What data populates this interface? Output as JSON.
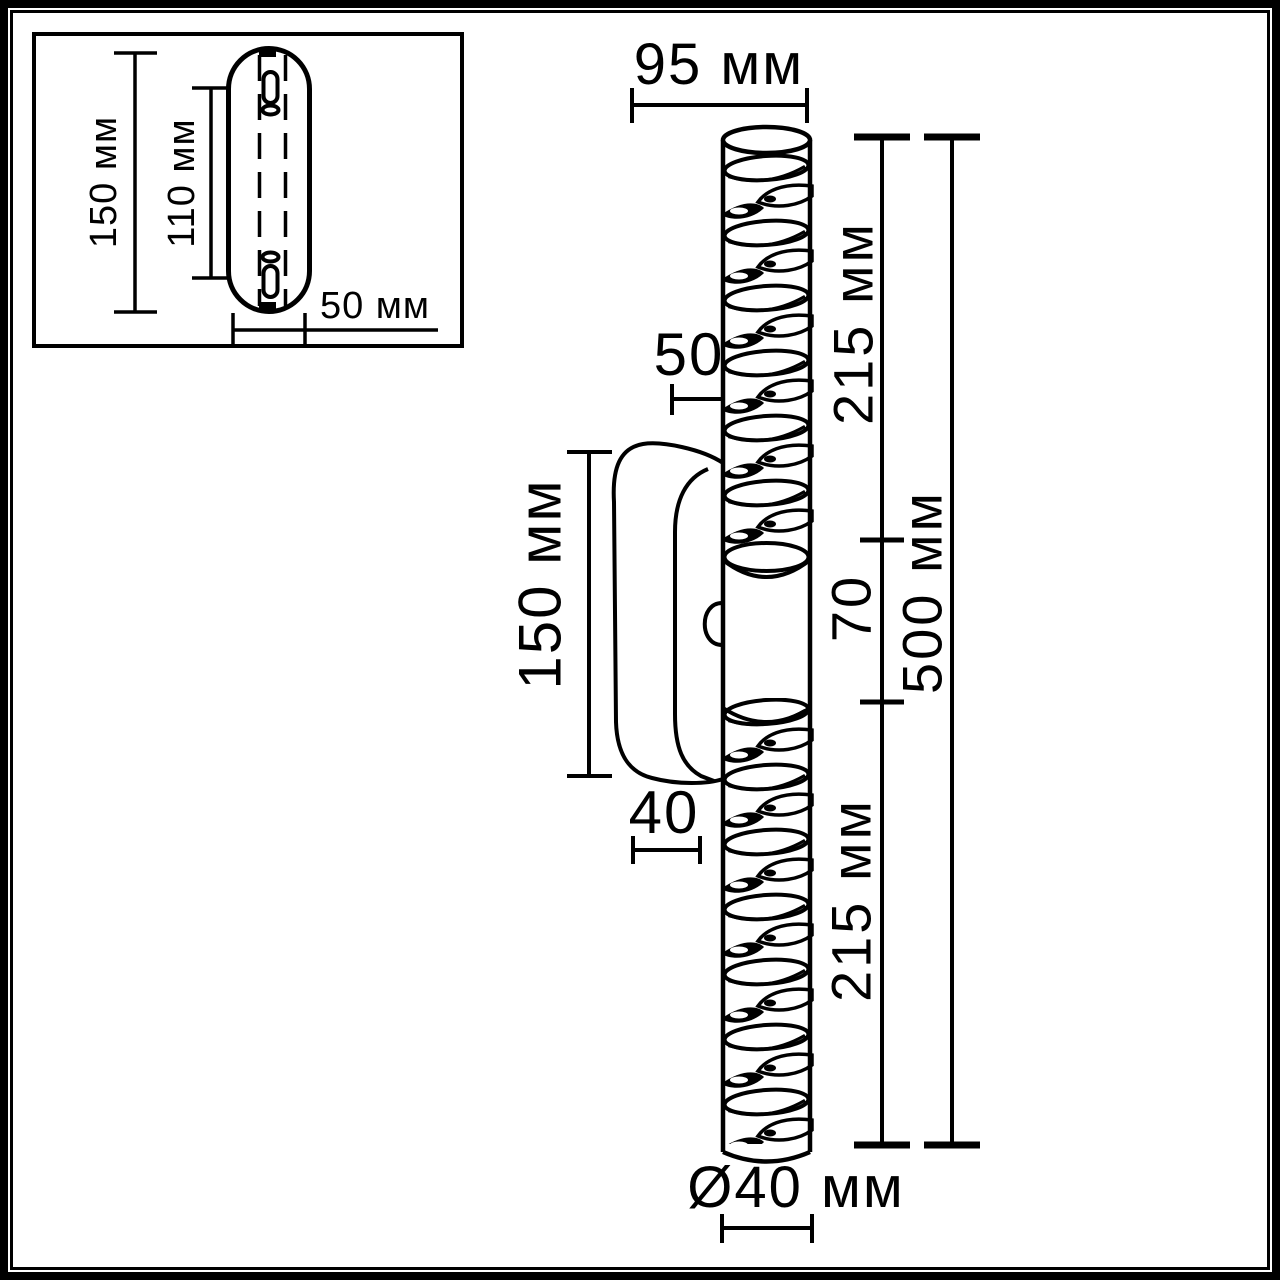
{
  "meta": {
    "drawing_type": "Технический чертёж настенного светильника",
    "unit": "мм"
  },
  "colors": {
    "line": "#000000",
    "background": "#ffffff"
  },
  "inset": {
    "plate_height_label": "150 мм",
    "holes_spacing_label": "110 мм",
    "plate_width_label": "50 мм"
  },
  "main": {
    "depth_label": "95 мм",
    "upper_segment_label": "215 мм",
    "wall_offset_top_label": "50",
    "bracket_height_label": "150 мм",
    "middle_segment_label": "70",
    "total_height_label": "500 мм",
    "bracket_offset_bottom_label": "40",
    "lower_segment_label": "215 мм",
    "diameter_label": "Ø40 мм"
  }
}
